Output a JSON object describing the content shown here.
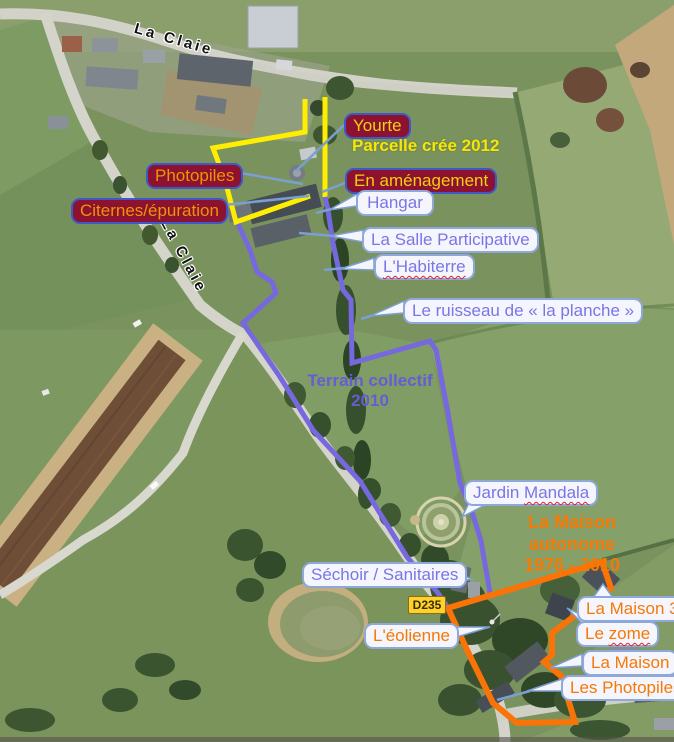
{
  "road_labels": {
    "top": "La Claie",
    "side": "La Claie"
  },
  "road_sign": {
    "text": "D235"
  },
  "area_titles": {
    "parcelle": {
      "text": "Parcelle crée 2012"
    },
    "terrain": {
      "line1": "Terrain collectif",
      "line2": "2010"
    },
    "maison_autonome": {
      "line1": "La Maison autonome",
      "line2": "1976 - 2010"
    }
  },
  "callouts": {
    "yourte": {
      "text": "Yourte"
    },
    "photopiles": {
      "text": "Photopiles"
    },
    "citernes": {
      "text": "Citernes/épuration"
    },
    "en_amenagement": {
      "text": "En aménagement"
    },
    "hangar": {
      "text": "Hangar"
    },
    "salle": {
      "text": "La Salle Participative"
    },
    "habiterre": {
      "text": "L'Habiterre"
    },
    "ruisseau": {
      "text": "Le ruisseau de « la planche »"
    },
    "jardin": {
      "word1": "Jardin",
      "word2": "Mandala"
    },
    "sechoir": {
      "text": "Séchoir / Sanitaires"
    },
    "eolienne": {
      "text": "L'éolienne"
    },
    "maison_3e": {
      "text": "La Maison 3E"
    },
    "zome": {
      "word1": "Le",
      "word2": "zome"
    },
    "maison": {
      "text": "La Maison"
    },
    "les_photopiles": {
      "text": "Les Photopiles"
    }
  },
  "colors": {
    "parcelle_outline": "#ffee00",
    "terrain_outline": "#7668de",
    "maison_outline": "#f97306",
    "maroon_label_bg": "#8c1230",
    "maroon_label_border": "#3f58c8",
    "white_label_bg": "#f5f5fd",
    "white_label_border": "#8fa8dc",
    "purple_text": "#7a76e4",
    "orange_text": "#f57905",
    "gold_text": "#f2cf12",
    "orange_gold_text": "#ef9405",
    "yellow_title": "#f5e60a",
    "purple_title": "#655cd6",
    "leader_line": "#7b9fd0",
    "sign_bg": "#ffd229",
    "sign_text": "#3a2b05",
    "road_name_text": "#111111"
  }
}
